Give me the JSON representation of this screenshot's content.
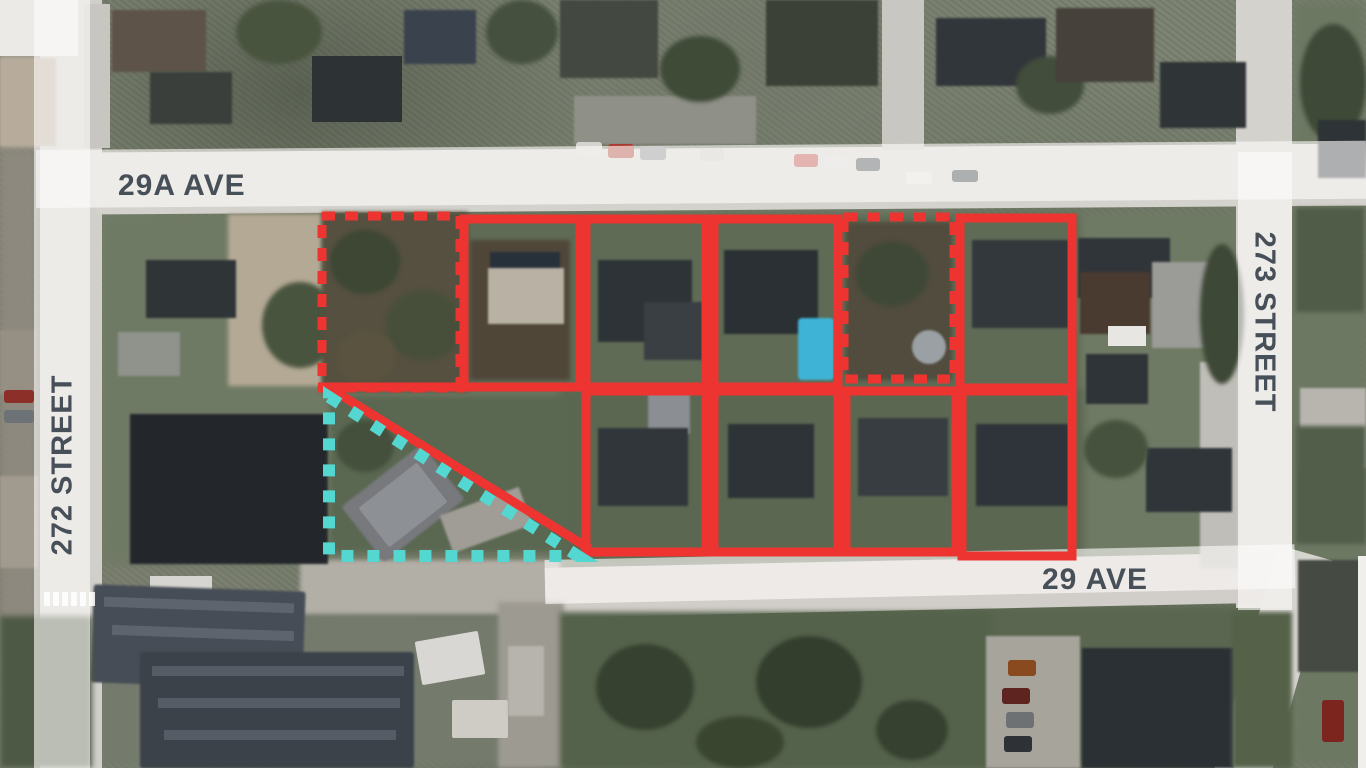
{
  "streets": {
    "ave_29a": "29A AVE",
    "st_272": "272 STREET",
    "st_273": "273 STREET",
    "ave_29": "29 AVE"
  },
  "overlay": {
    "colors": {
      "boundary_red": "#ee3430",
      "excluded_teal": "#54d7d0",
      "street_label": "#474f58",
      "road_band": "rgba(253,252,250,0.62)"
    },
    "parcels_solid_red": [
      {
        "id": "lot-2",
        "x": 464,
        "y": 219,
        "w": 116,
        "h": 168
      },
      {
        "id": "lot-3",
        "x": 586,
        "y": 219,
        "w": 120,
        "h": 168
      },
      {
        "id": "lot-4",
        "x": 714,
        "y": 219,
        "w": 124,
        "h": 168
      },
      {
        "id": "lot-6",
        "x": 960,
        "y": 218,
        "w": 112,
        "h": 170
      },
      {
        "id": "lot-7",
        "x": 586,
        "y": 391,
        "w": 120,
        "h": 161
      },
      {
        "id": "lot-8",
        "x": 714,
        "y": 391,
        "w": 124,
        "h": 161
      },
      {
        "id": "lot-9",
        "x": 846,
        "y": 391,
        "w": 110,
        "h": 161
      },
      {
        "id": "lot-10",
        "x": 962,
        "y": 391,
        "w": 110,
        "h": 165
      }
    ],
    "parcels_dashed_red": [
      {
        "id": "lot-1",
        "x": 322,
        "y": 216,
        "w": 138,
        "h": 172
      },
      {
        "id": "lot-5",
        "x": 844,
        "y": 217,
        "w": 110,
        "h": 162
      }
    ],
    "excluded_lot_dashed_teal": {
      "points": "329,397 578,556 329,556"
    },
    "boundary_diagonal_red": {
      "x1": 326,
      "y1": 386,
      "x2": 590,
      "y2": 549
    },
    "boundary_segment_red": {
      "x1": 318,
      "y1": 387,
      "x2": 592,
      "y2": 387
    }
  }
}
